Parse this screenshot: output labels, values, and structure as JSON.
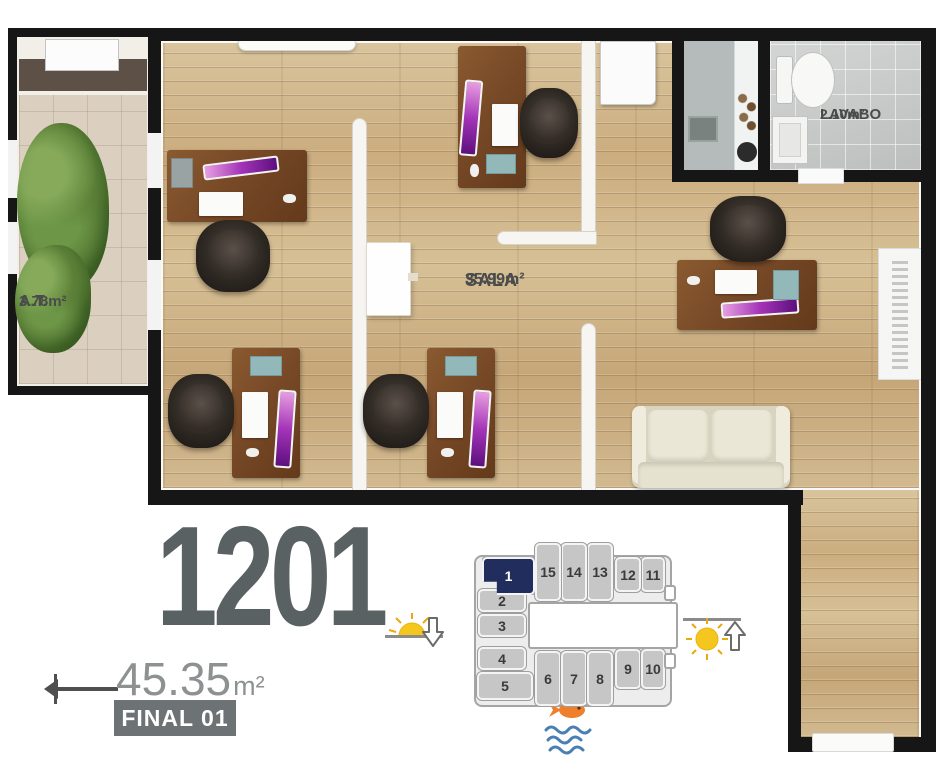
{
  "plan": {
    "rooms": {
      "at": {
        "name": "A.T.",
        "area": "3.78m²"
      },
      "sala": {
        "name": "SALA",
        "area": "35.99m²"
      },
      "lavabo": {
        "name": "LAVABO",
        "area": "2.10m²"
      }
    },
    "furniture": {
      "desks": 5,
      "office_chairs": 5,
      "sofas": 1,
      "toilets": 1,
      "plants": 1
    }
  },
  "legend": {
    "unit_number": "1201",
    "area_value": "45.35",
    "area_unit": "m²",
    "final_label": "FINAL 01"
  },
  "keyplan": {
    "highlighted_unit": "1",
    "units": [
      "1",
      "2",
      "3",
      "4",
      "5",
      "6",
      "7",
      "8",
      "9",
      "10",
      "11",
      "12",
      "13",
      "14",
      "15"
    ]
  },
  "icons": {
    "left": "sun-with-down-arrow-icon",
    "right": "sun-with-up-arrow-icon",
    "bottom": "fish-over-waves-icon"
  },
  "colors": {
    "highlight_navy": "#212d5d",
    "keyplan_unit_gray": "#c6c6c6",
    "unit_number_gray": "#5a6162",
    "badge_gray": "#6d7374",
    "wood_floor": "#cdb28a",
    "desk_brown": "#774927",
    "screen_purple": "#a434b8",
    "sun_yellow": "#f5c61e",
    "wave_blue": "#4a7fb5",
    "fish_orange": "#ef7f2a"
  }
}
